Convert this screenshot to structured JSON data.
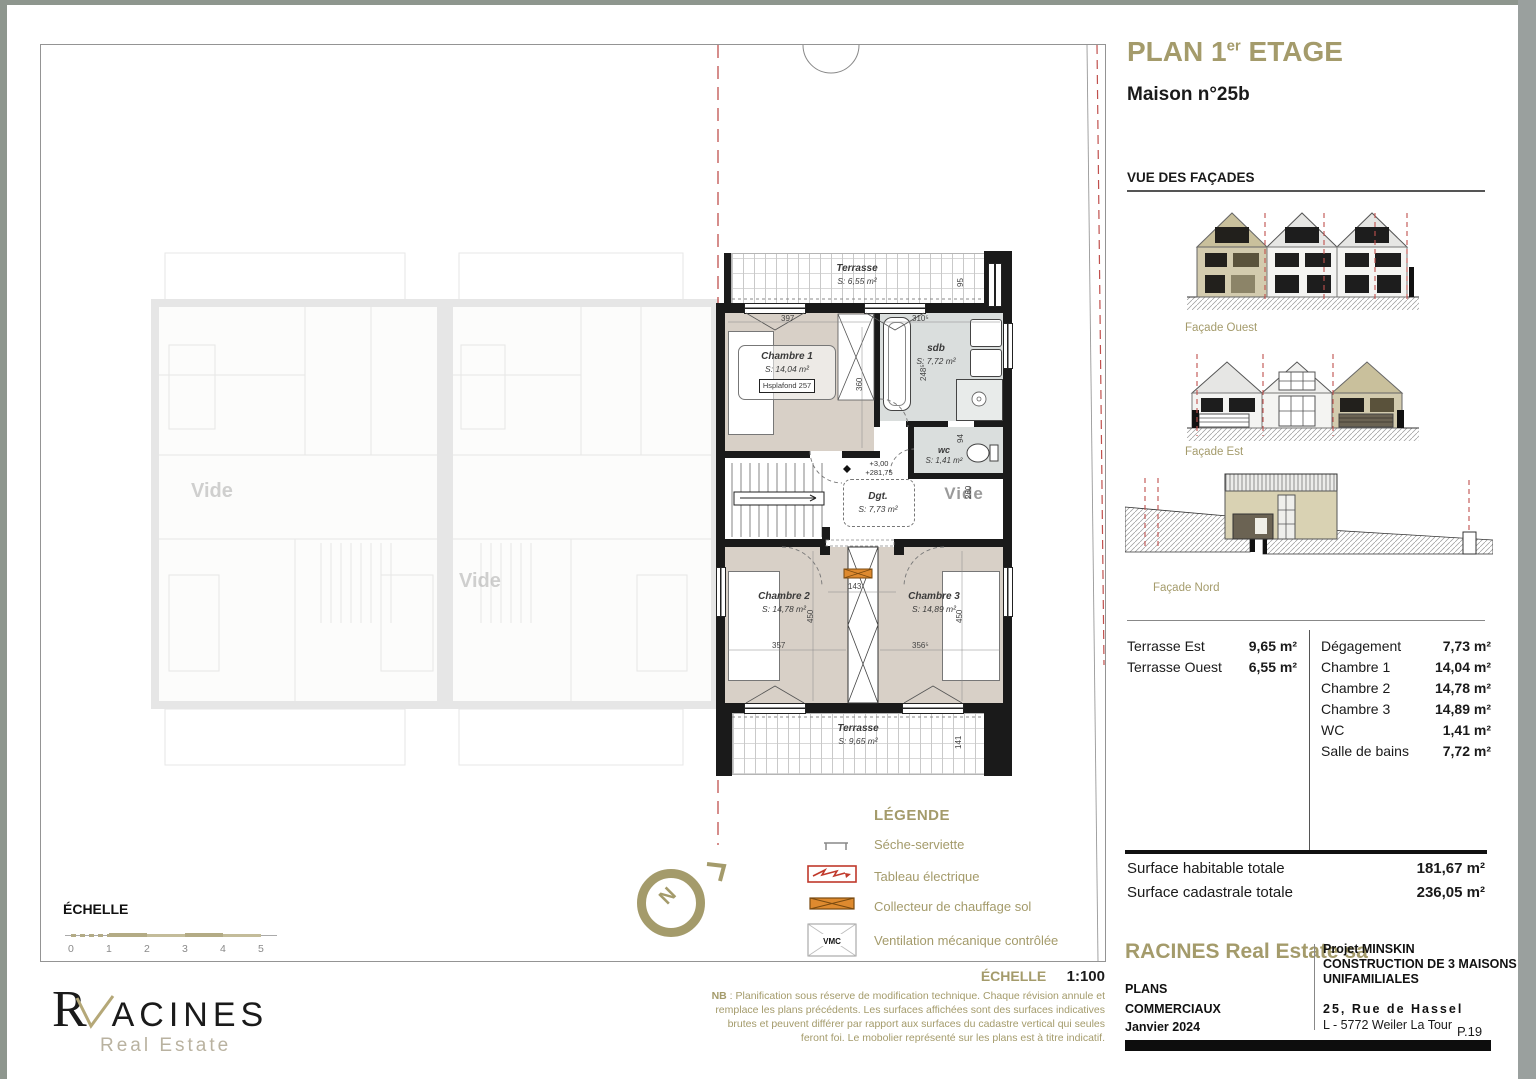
{
  "colors": {
    "accent": "#a49b6b",
    "cut_line_red": "#c0504d",
    "room_beige": "#d8d0c7",
    "bath_gray": "#dadedd",
    "collector_orange": "#de8a2f",
    "wall_black": "#1a1a1a"
  },
  "header": {
    "title_prefix": "PLAN 1",
    "title_sup": "er",
    "title_suffix": " ETAGE",
    "subtitle": "Maison n°25b"
  },
  "facades": {
    "section_title": "VUE DES FAÇADES",
    "ouest": "Façade Ouest",
    "est": "Façade Est",
    "nord": "Façade Nord"
  },
  "surface_table": {
    "left": [
      {
        "name": "Terrasse Est",
        "value": "9,65 m²"
      },
      {
        "name": "Terrasse Ouest",
        "value": "6,55 m²"
      }
    ],
    "right": [
      {
        "name": "Dégagement",
        "value": "7,73 m²"
      },
      {
        "name": "Chambre 1",
        "value": "14,04 m²"
      },
      {
        "name": "Chambre 2",
        "value": "14,78 m²"
      },
      {
        "name": "Chambre 3",
        "value": "14,89 m²"
      },
      {
        "name": "WC",
        "value": "1,41 m²"
      },
      {
        "name": "Salle de bains",
        "value": "7,72 m²"
      }
    ]
  },
  "totals": [
    {
      "label": "Surface habitable totale",
      "value": "181,67 m²"
    },
    {
      "label": "Surface cadastrale totale",
      "value": "236,05 m²"
    }
  ],
  "footer": {
    "company": "RACINES Real Estate sa",
    "doc1": "PLANS",
    "doc2": "COMMERCIAUX",
    "date": "Janvier 2024",
    "project1": "Projet MINSKIN",
    "project2": "CONSTRUCTION DE 3 MAISONS",
    "project3": "UNIFAMILIALES",
    "addr1": "25, Rue de Hassel",
    "addr2": "L - 5772 Weiler La Tour",
    "page": "P.19"
  },
  "legend": {
    "title": "LÉGENDE",
    "items": [
      {
        "label": "Séche-serviette"
      },
      {
        "label": "Tableau électrique"
      },
      {
        "label": "Collecteur de chauffage sol"
      },
      {
        "label": "Ventilation mécanique contrôlée"
      }
    ],
    "vmc": "VMC"
  },
  "scalebar": {
    "label": "ÉCHELLE",
    "ticks": [
      "0",
      "1",
      "2",
      "3",
      "4",
      "5"
    ]
  },
  "scale_note": {
    "label": "ÉCHELLE",
    "value": "1:100"
  },
  "nb_note": {
    "bold": "NB",
    "text": " : Planification sous réserve de modification technique. Chaque révision annule et remplace les plans précédents. Les surfaces affichées sont des surfaces indicatives brutes et peuvent différer par rapport aux surfaces du cadastre vertical qui seules feront foi. Le mobolier représenté sur les plans est à titre indicatif."
  },
  "logo": {
    "first": "R",
    "rest": "ACINES",
    "tagline": "Real Estate"
  },
  "plan": {
    "terrasse_top": {
      "name": "Terrasse",
      "area": "S: 6,55 m²"
    },
    "terrasse_bottom": {
      "name": "Terrasse",
      "area": "S: 9,65 m²"
    },
    "chambre1": {
      "name": "Chambre 1",
      "area": "S: 14,04 m²",
      "ceiling": "Hsplafond 257"
    },
    "chambre2": {
      "name": "Chambre 2",
      "area": "S: 14,78 m²"
    },
    "chambre3": {
      "name": "Chambre 3",
      "area": "S: 14,89 m²"
    },
    "sdb": {
      "name": "sdb",
      "area": "S: 7,72 m²"
    },
    "wc": {
      "name": "wc",
      "area": "S: 1,41 m²"
    },
    "dgt": {
      "name": "Dgt.",
      "area": "S: 7,73 m²",
      "level_top": "+3,00",
      "level_bottom": "+281,75"
    },
    "vide": "Vide",
    "ghost_vide": "Vide",
    "compass_n": "N",
    "dims": {
      "d397": "397",
      "d360": "360",
      "d310": "310⁵",
      "d248": "248⁵",
      "d95": "95",
      "d94": "94",
      "d143": "143",
      "d357": "357",
      "d356": "356⁵",
      "d450a": "450",
      "d450b": "450",
      "d141": "141",
      "d260": "260"
    }
  }
}
